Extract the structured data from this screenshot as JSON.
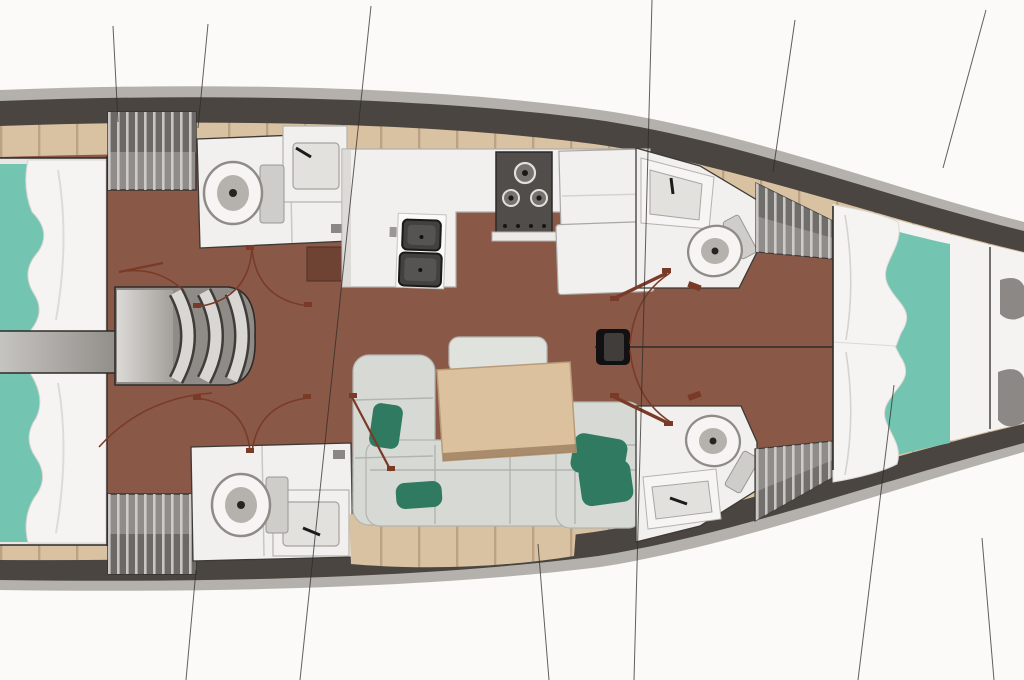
{
  "image": {
    "title": "Sailing yacht interior layout — top-down deck plan, bow to the right",
    "kind": "boat-floor-plan"
  },
  "colors": {
    "bg": "#fbfaf8",
    "hull_rim": "#b4b1ad",
    "hull_dark": "#4a4541",
    "deck": "#d9c2a2",
    "plank_line": "#b1967a",
    "floor": "#8a5847",
    "floor_dark": "#6f4334",
    "teal": "#74c4b2",
    "duvet": "#f5f4f2",
    "fixture": "#f1f0ee",
    "fixture_inner": "#e3e1de",
    "cushion": "#d7d9d5",
    "cushion_line": "#b2b4b0",
    "pillow": "#2f7a60",
    "table": "#dcc19e",
    "table_edge": "#b99c78",
    "hatch_mid": "#8f8c89",
    "hatch_dark": "#6b6865",
    "hatch_line": "#d8d6d3",
    "stove": "#504d4b",
    "sink": "#434140",
    "dark_line": "#2e2b28",
    "door": "#7a3a28",
    "corridor": "#b0aeaa"
  },
  "rooms": {
    "hull": "Hull with dark bulwark band and light rubbing strake",
    "side_decks": "Beige side-deck plank strip",
    "aft_cabin_top": "Aft double cabin (top) with teal mattress and white duvet",
    "aft_cabin_bottom": "Aft double cabin (bottom) with teal mattress and white duvet",
    "corridor": "Passage between aft cabins",
    "lockers": "Hatched hanging lockers / stowage",
    "head_aft_top": "Aft head (top) with toilet and sink",
    "head_aft_bottom": "Aft head (bottom) with toilet and sink",
    "stairs": "Companionway steps",
    "galley": "L-shaped galley worktop",
    "stove": "Three-burner stove",
    "sinks": "Twin galley sinks",
    "fridge_units": "Fridge / counter units",
    "sideboard": "Dark sideboard locker",
    "salon": "Salon U-settee with green scatter cushions",
    "table": "Salon table",
    "nav_seat": "Navigation desk / seat",
    "mast": "Mast step on centerline",
    "centerline": "Centerline",
    "head_fwd_top": "Forward head (top) with toilet and sink",
    "head_fwd_bottom": "Forward head (bottom) with toilet and sink",
    "berth_fwd": "Forward V-berth with teal runner",
    "forepeak": "Forepeak / anchor stowage",
    "doors": "Cabin door swing arcs",
    "section_lines": "Rig / section reference lines"
  }
}
